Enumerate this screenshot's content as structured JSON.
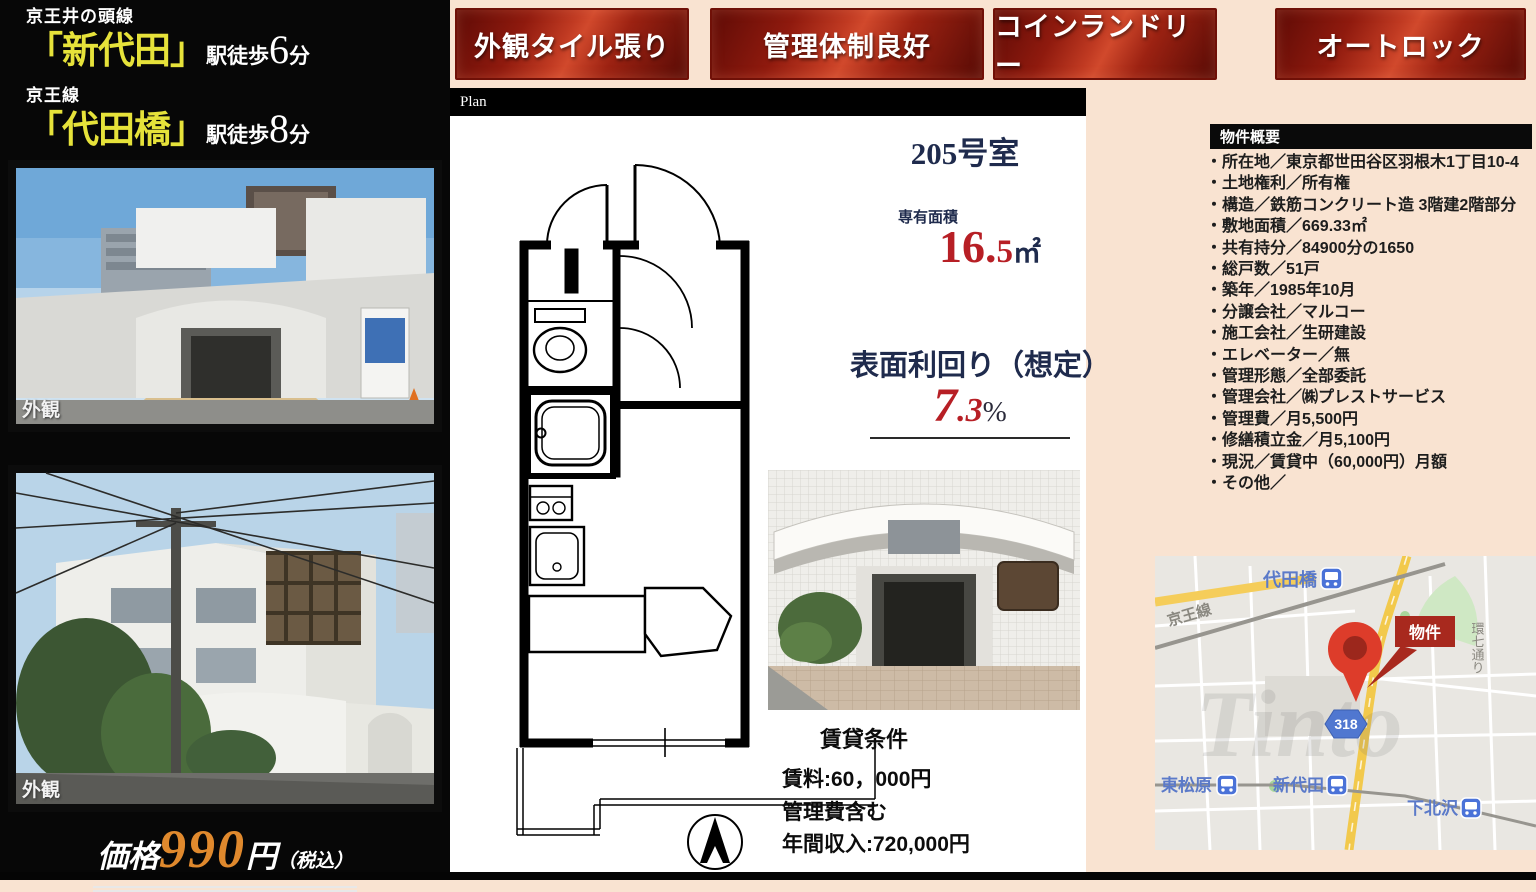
{
  "stations": {
    "line1_label": "京王井の頭線",
    "line1_name": "「新代田」",
    "line1_walk": "駅徒歩",
    "line1_min": "6",
    "line1_suffix": "分",
    "line2_label": "京王線",
    "line2_name": "「代田橋」",
    "line2_walk": "駅徒歩",
    "line2_min": "8",
    "line2_suffix": "分"
  },
  "feature_buttons": [
    {
      "label": "外観タイル張り"
    },
    {
      "label": "管理体制良好"
    },
    {
      "label": "コインランドリー"
    },
    {
      "label": "オートロック"
    }
  ],
  "plan": {
    "bar_label": "Plan",
    "room_title": "205号室",
    "area_label": "専有面積",
    "area_main": "16.",
    "area_sub": "5",
    "area_unit": "㎡",
    "yield_label": "表面利回り（想定）",
    "yield_main": "7",
    "yield_sub": ".3",
    "yield_unit": "%"
  },
  "photos": {
    "photo1_caption": "外観",
    "photo2_caption": "外観"
  },
  "price": {
    "prefix": "価格",
    "amount": "990",
    "unit": "円",
    "tax": "（税込）"
  },
  "overview": {
    "header": "物件概要",
    "items": [
      "・所在地／東京都世田谷区羽根木1丁目10-4",
      "・土地権利／所有権",
      "・構造／鉄筋コンクリート造 3階建2階部分",
      "・敷地面積／669.33㎡",
      "・共有持分／84900分の1650",
      "・総戸数／51戸",
      "・築年／1985年10月",
      "・分譲会社／マルコー",
      "・施工会社／生研建設",
      "・エレベーター／無",
      "・管理形態／全部委託",
      "・管理会社／㈱プレストサービス",
      "・管理費／月5,500円",
      "・修繕積立金／月5,100円",
      "・現況／賃貸中（60,000円）月額",
      "・その他／"
    ]
  },
  "rental": {
    "header": "賃貸条件",
    "lines": [
      "賃料:60，000円",
      "管理費含む",
      "年間収入:720,000円"
    ]
  },
  "map": {
    "station_daitabashi": "代田橋",
    "station_higashimatsubara": "東松原",
    "station_shindaita": "新代田",
    "station_shimokitazawa": "下北沢",
    "railway_label": "京王線",
    "road_label": "環七通り",
    "route_number": "318",
    "pin_label": "物件",
    "watermark": "Tinto"
  },
  "colors": {
    "accent_red": "#b71f25",
    "navy": "#1f2b4d",
    "button_red": "#c03a22",
    "price_orange": "#e0892d",
    "station_yellow": "#e6e23a",
    "map_road_yellow": "#f2c94c",
    "map_station_blue": "#4a72d8"
  }
}
